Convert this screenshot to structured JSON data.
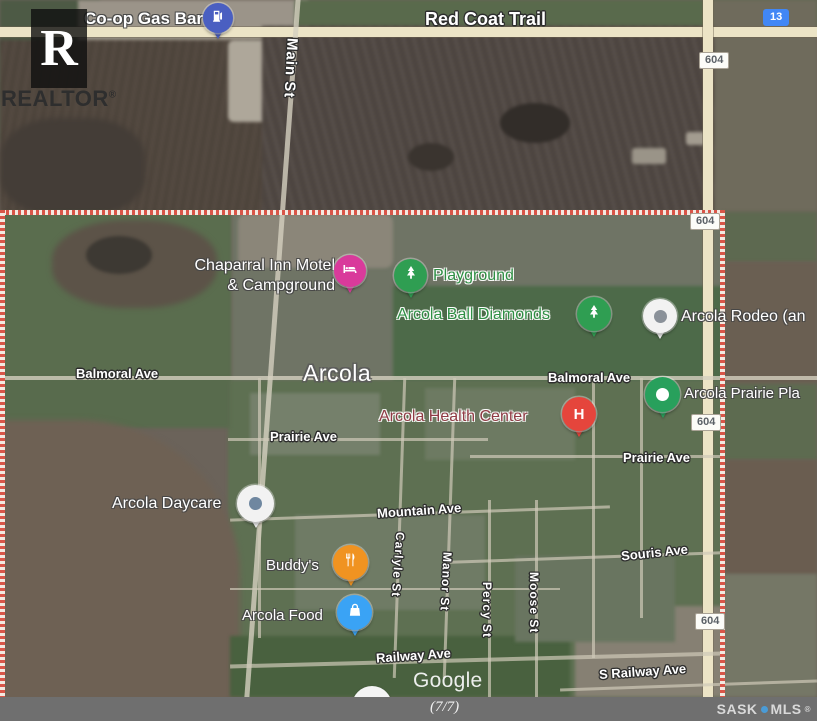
{
  "watermarks": {
    "realtor": {
      "letter": "R",
      "label": "REALTOR",
      "reg": "®"
    },
    "google": "Google"
  },
  "footer": {
    "page_indicator": "(7/7)",
    "brand": {
      "sask": "SASK",
      "mls": "MLS",
      "reg": "®",
      "dot_color": "#4a9bd6"
    },
    "bg": "#6f6f6f"
  },
  "map": {
    "city_label": "Arcola",
    "boundary_color": "#d95548",
    "road_labels": [
      {
        "text": "Red Coat Trail"
      },
      {
        "text": "Main St"
      },
      {
        "text": "Balmoral Ave"
      },
      {
        "text": "Balmoral Ave"
      },
      {
        "text": "Prairie Ave"
      },
      {
        "text": "Prairie Ave"
      },
      {
        "text": "Mountain Ave"
      },
      {
        "text": "Souris Ave"
      },
      {
        "text": "Carlyle St"
      },
      {
        "text": "Manor St"
      },
      {
        "text": "Percy St"
      },
      {
        "text": "Moose St"
      },
      {
        "text": "Railway Ave"
      },
      {
        "text": "S Railway Ave"
      }
    ],
    "route_badges": [
      {
        "text": "13",
        "color": "#4187f5"
      },
      {
        "text": "604",
        "color": "#fcfcf8"
      },
      {
        "text": "604",
        "color": "#fcfcf8"
      },
      {
        "text": "604",
        "color": "#fcfcf8"
      },
      {
        "text": "604",
        "color": "#fcfcf8"
      }
    ],
    "pois": [
      {
        "name": "Co-op Gas Bar",
        "icon": "gas-pump",
        "color": "#4a5fc1"
      },
      {
        "name": "Chaparral Inn Motel & Campground",
        "lines": [
          "Chaparral Inn Motel",
          "& Campground"
        ],
        "icon": "bed",
        "color": "#d93a9b"
      },
      {
        "name": "Playground",
        "icon": "tree",
        "color": "#2f9e52",
        "text_color": "#2f8f44"
      },
      {
        "name": "Arcola Ball Diamonds",
        "icon": "tree",
        "color": "#2f9e52",
        "text_color": "#2f8f44"
      },
      {
        "name": "Arcola Rodeo (an",
        "icon": "dot",
        "color": "#f2f2f2",
        "dot_color": "#8a9199"
      },
      {
        "name": "Arcola Prairie Pla",
        "icon": "dot",
        "color": "#28a05c",
        "dot_color": "#ffffff"
      },
      {
        "name": "Arcola Health Center",
        "icon": "hospital-h",
        "icon_letter": "H",
        "color": "#e5453c",
        "text_color": "#8f3b44"
      },
      {
        "name": "Arcola Daycare",
        "icon": "dot",
        "color": "#f2f2f2",
        "dot_color": "#6f87a0"
      },
      {
        "name": "Buddy's",
        "icon": "restaurant",
        "color": "#f09321"
      },
      {
        "name": "Arcola Food",
        "icon": "shopping-bag",
        "color": "#3aa3f5"
      }
    ]
  }
}
